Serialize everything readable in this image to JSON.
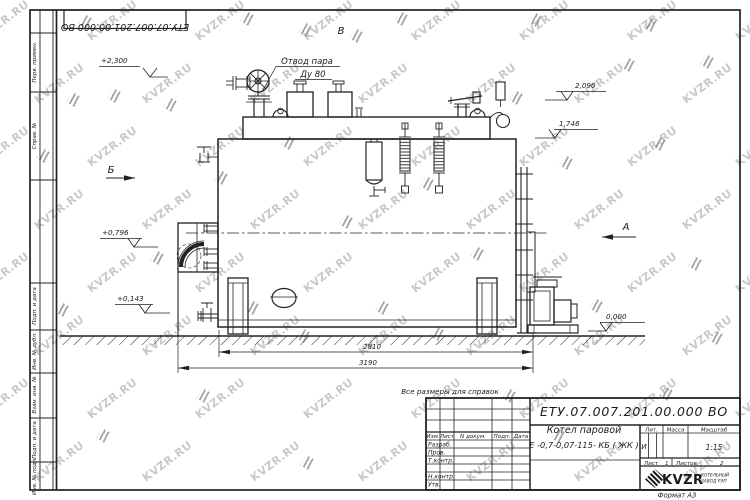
{
  "doc": {
    "number": "ЕТУ.07.007.201.00.000  ВО",
    "note": "Все размеры для справок",
    "format": "Формат А3"
  },
  "drawing": {
    "callout1": "Отвод пара",
    "callout2": "Ду 80",
    "view_v": "В",
    "view_b": "Б",
    "view_a": "А",
    "elev_2300": "+2,300",
    "elev_2090": "2,090",
    "elev_1746": "1,746",
    "elev_0796": "+0,796",
    "elev_0143": "+0,143",
    "elev_0000": "0,000",
    "dim_2810": "2810",
    "dim_3190": "3190"
  },
  "titleblock": {
    "number": "ЕТУ.07.007.201.00.000  ВО",
    "name_line1": "Котел паровой",
    "name_line2": "Е -0,7-0,07-115- КБ ( ЖК )",
    "header_cols": [
      "Изм.",
      "Лист",
      "N докум.",
      "Подп.",
      "Дата"
    ],
    "rows": [
      "Разраб.",
      "Пров.",
      "Т.контр.",
      "Н.контр.",
      "Утв."
    ],
    "lit_label": "Лит.",
    "mass_label": "Масса",
    "scale_label": "Масштаб",
    "lit_value": "И",
    "scale_value": "1:15",
    "sheet_label": "Лист",
    "sheet_value": "1",
    "sheets_label": "Листов",
    "sheets_value": "2",
    "brand": "KVZR",
    "brand_sub1": "КОТЕЛЬНЫЙ",
    "brand_sub2": "ЗАВОД РЭП"
  },
  "frame": {
    "side_labels": [
      "Перв. примен.",
      "Справ. №",
      "Подп. и дата",
      "Инв. № дубл.",
      "Взам. инв. №",
      "Подп. и дата",
      "Инв. № подл."
    ]
  },
  "watermark": {
    "text": "KVZR.RU",
    "color": "#c9c9c9",
    "logo_color": "#8d8d8d",
    "line_color": "#222222"
  }
}
